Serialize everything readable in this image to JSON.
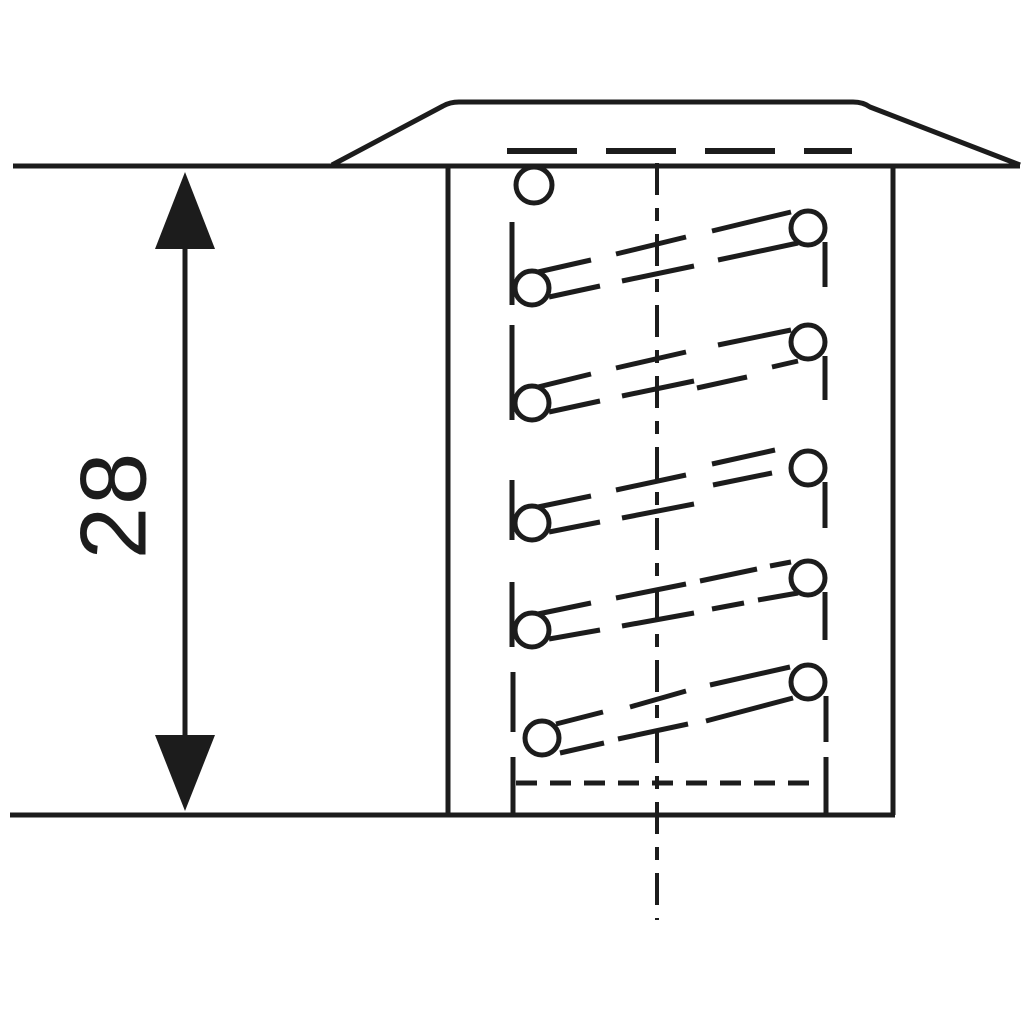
{
  "page": {
    "background": "#ffffff"
  },
  "drawing": {
    "description": "Technical section view of a flanged self-tapping threaded insert (coil thread) installed flush with a surface, with installed length dimensioned",
    "line_color": "#1c1c1c",
    "dimension": {
      "label": "28",
      "orientation": "vertical"
    }
  },
  "geometry": {
    "coil_circles": [
      [
        534,
        185,
        18
      ],
      [
        532,
        288,
        17
      ],
      [
        808,
        228,
        17
      ],
      [
        532,
        403,
        17
      ],
      [
        808,
        342,
        17
      ],
      [
        532,
        523,
        17
      ],
      [
        808,
        468,
        17
      ],
      [
        532,
        630,
        17
      ],
      [
        808,
        578,
        17
      ],
      [
        542,
        738,
        17
      ],
      [
        808,
        682,
        17
      ]
    ],
    "coil_lines": [
      [
        512,
        222,
        512,
        305
      ],
      [
        825,
        242,
        825,
        287
      ],
      [
        538,
        272,
        591,
        260
      ],
      [
        616,
        254,
        686,
        237
      ],
      [
        712,
        231,
        791,
        212
      ],
      [
        549,
        297,
        600,
        286
      ],
      [
        622,
        281,
        694,
        266
      ],
      [
        718,
        260,
        798,
        243
      ],
      [
        512,
        325,
        512,
        420
      ],
      [
        825,
        356,
        825,
        400
      ],
      [
        538,
        387,
        591,
        374
      ],
      [
        616,
        368,
        686,
        352
      ],
      [
        718,
        345,
        791,
        330
      ],
      [
        549,
        412,
        600,
        401
      ],
      [
        622,
        396,
        694,
        381
      ],
      [
        697,
        388,
        747,
        377
      ],
      [
        772,
        367,
        798,
        361
      ],
      [
        512,
        480,
        512,
        540
      ],
      [
        825,
        482,
        825,
        528
      ],
      [
        538,
        507,
        591,
        496
      ],
      [
        616,
        490,
        686,
        475
      ],
      [
        712,
        464,
        775,
        450
      ],
      [
        549,
        532,
        600,
        522
      ],
      [
        622,
        518,
        694,
        504
      ],
      [
        713,
        485,
        772,
        473
      ],
      [
        512,
        582,
        512,
        647
      ],
      [
        825,
        592,
        825,
        640
      ],
      [
        538,
        614,
        591,
        603
      ],
      [
        616,
        598,
        686,
        584
      ],
      [
        700,
        581,
        757,
        569
      ],
      [
        770,
        566,
        791,
        562
      ],
      [
        549,
        639,
        600,
        630
      ],
      [
        622,
        626,
        694,
        613
      ],
      [
        712,
        609,
        744,
        603
      ],
      [
        758,
        600,
        798,
        593
      ],
      [
        513,
        672,
        513,
        732
      ],
      [
        826,
        696,
        826,
        742
      ],
      [
        556,
        724,
        603,
        712
      ],
      [
        630,
        707,
        686,
        691
      ],
      [
        710,
        685,
        790,
        667
      ],
      [
        560,
        753,
        604,
        743
      ],
      [
        618,
        739,
        688,
        724
      ],
      [
        706,
        721,
        793,
        698
      ],
      [
        513,
        757,
        513,
        816
      ],
      [
        826,
        757,
        826,
        816
      ]
    ],
    "dashed_lines": [
      {
        "x1": 507,
        "y1": 151,
        "x2": 852,
        "y2": 151,
        "dash": "70 29",
        "width": 6,
        "name": "flange-hidden-edge"
      },
      {
        "x1": 657,
        "y1": 163,
        "x2": 657,
        "y2": 920,
        "dash": "32 13 13 13",
        "width": 4,
        "name": "vertical-centerline"
      },
      {
        "x1": 516,
        "y1": 783,
        "x2": 818,
        "y2": 783,
        "dash": "21 13",
        "width": 5,
        "name": "bore-bottom-hidden-line"
      }
    ]
  }
}
